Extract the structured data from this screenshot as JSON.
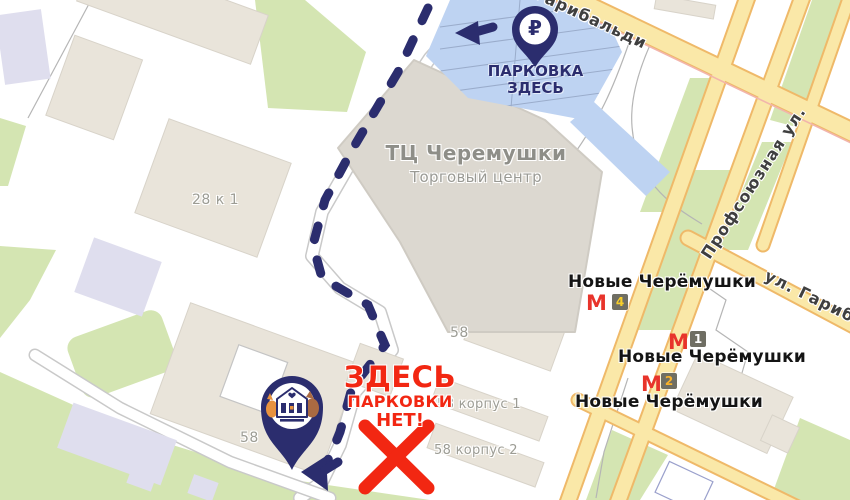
{
  "annotations": {
    "ruble": "₽",
    "parking_here": {
      "line1": "ПАРКОВКА",
      "line2": "ЗДЕСЬ"
    },
    "no_parking": {
      "line1": "ЗДЕСЬ",
      "line2": "ПАРКОВКИ",
      "line3": "НЕТ!"
    }
  },
  "mall": {
    "title": "ТЦ Черемушки",
    "subtitle": "Торговый центр"
  },
  "streets": {
    "garibaldi_top": "Гарибальди",
    "profsoyuznaya": "Профсоюзная ул.",
    "garibaldi_right": "ул. Гарибальди"
  },
  "metro": {
    "m_glyph": "М",
    "stations": [
      {
        "name": "Новые Черёмушки",
        "exit": "4"
      },
      {
        "name": "Новые Черёмушки",
        "exit": "1"
      },
      {
        "name": "Новые Черёмушки",
        "exit": "2"
      }
    ]
  },
  "buildings": {
    "b28k1": "28 к 1",
    "b58_center": "58",
    "b58_left": "58",
    "b58k1": "58 корпус 1",
    "b58k2": "58 корпус 2"
  },
  "colors": {
    "navy": "#2b2d6e",
    "alert_red": "#f22712",
    "metro_red": "#e8342b",
    "road_fill": "#fae8a8",
    "road_edge": "#efb969",
    "parking_blue": "#bed3f2",
    "green": "#d4e5b2",
    "building_beige": "#e9e4da",
    "building_lavender": "#dfdeee",
    "badge_bg": "#6f6e63",
    "badge_yellow": "#f8cf2a"
  }
}
